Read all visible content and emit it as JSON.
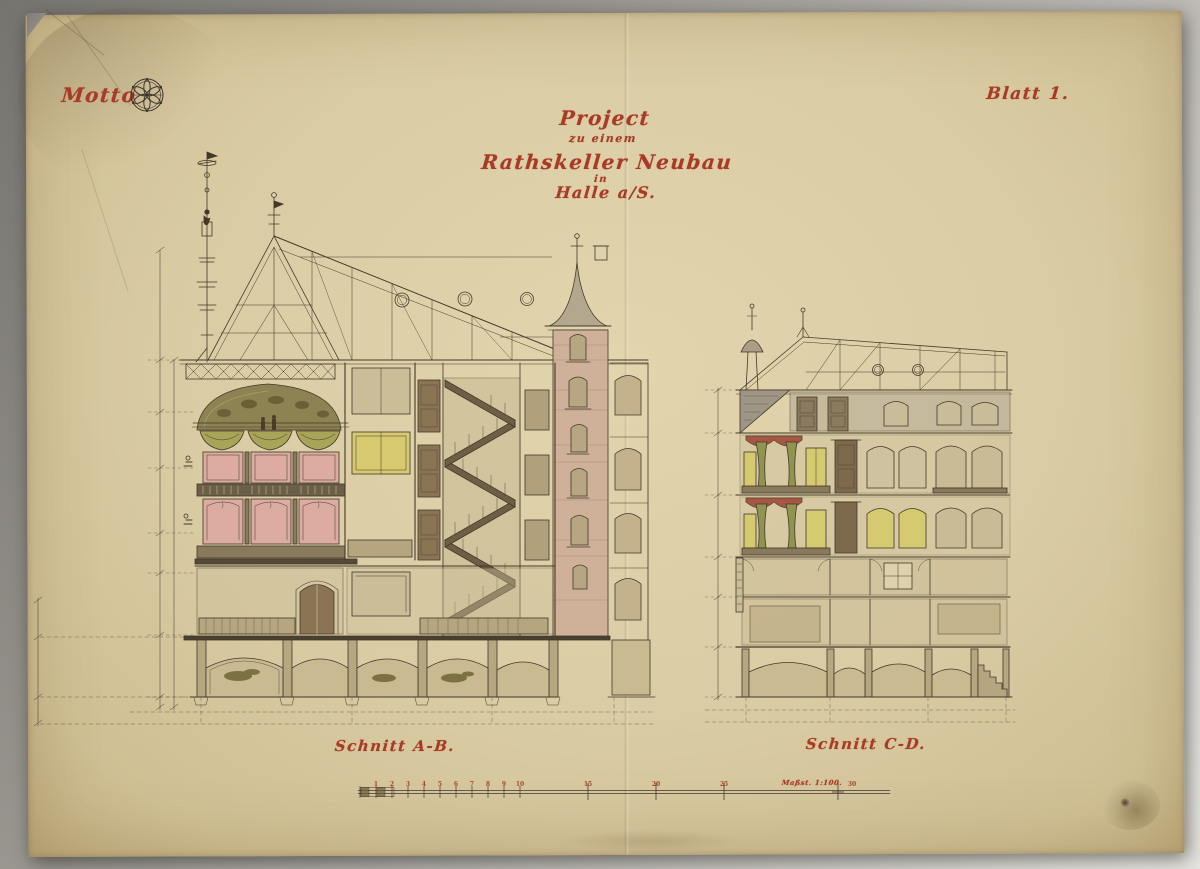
{
  "artwork": {
    "motto_label": "Motto",
    "sheet_label": "Blatt 1.",
    "title": {
      "line1": "Project",
      "line2": "zu einem",
      "line3": "Rathskeller Neubau",
      "line4": "in",
      "line5": "Halle a/S."
    },
    "captions": {
      "left_section": "Schnitt A-B.",
      "right_section": "Schnitt C-D."
    },
    "scale_bar": {
      "label": "Maßst. 1:100.",
      "ticks": [
        "1",
        "2",
        "3",
        "4",
        "5",
        "6",
        "7",
        "8",
        "9",
        "10",
        "15",
        "20",
        "25",
        "30"
      ]
    },
    "icons": {
      "rosette": "hexafoil-rosette"
    },
    "colors": {
      "ink_red": "#a93a26",
      "ink_sepia": "#43392b",
      "paper": "#dacca4",
      "wash_pink": "#dcaca1",
      "wash_olive": "#8d8252",
      "wash_green": "#a8a458",
      "wash_yellow": "#d6c96f",
      "wash_brick": "#cfb199",
      "wash_gray": "#a79e8e"
    }
  }
}
